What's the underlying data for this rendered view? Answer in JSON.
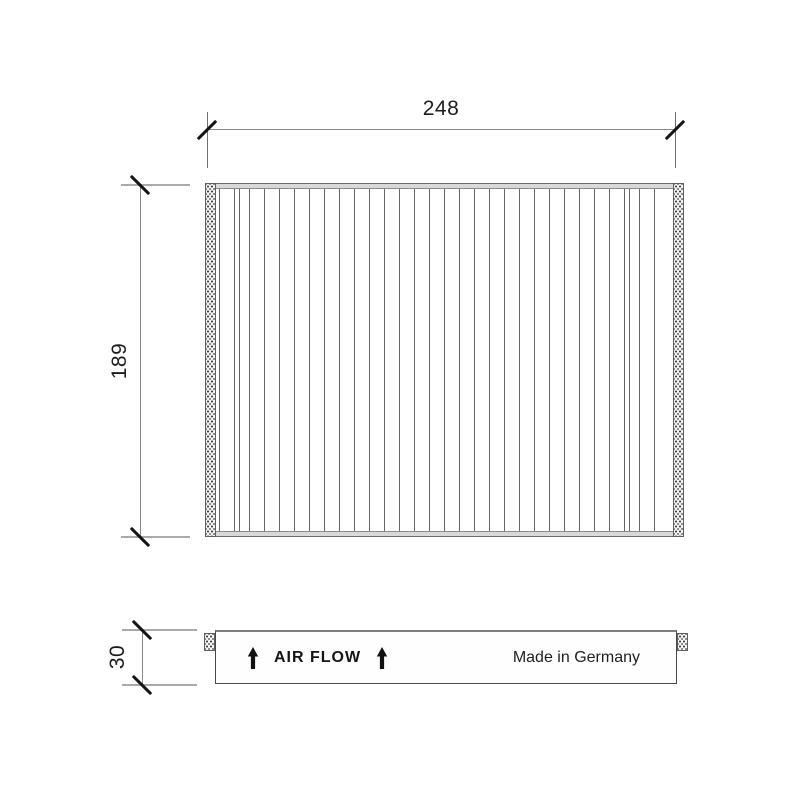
{
  "drawing": {
    "kind": "pleated-filter-technical-drawing",
    "views": [
      "top-view",
      "side-view"
    ]
  },
  "dimensions": {
    "width": "248",
    "height": "189",
    "depth": "30"
  },
  "top_view": {
    "pleats": {
      "count": 30,
      "double_line_indices": [
        1,
        27
      ]
    }
  },
  "side_view": {
    "air_flow_label": "AIR FLOW",
    "made_in_label": "Made in Germany",
    "arrow_icon": "up-arrow"
  },
  "colors": {
    "background": "#ffffff",
    "dimension_line": "#8a8a8a",
    "extension_line": "#aaaaaa",
    "tick": "#141414",
    "text": "#1c1c1c",
    "pleat_line": "#646464",
    "frame_band": "#d8d8d8",
    "gasket_fill": "#f4f4f4"
  }
}
